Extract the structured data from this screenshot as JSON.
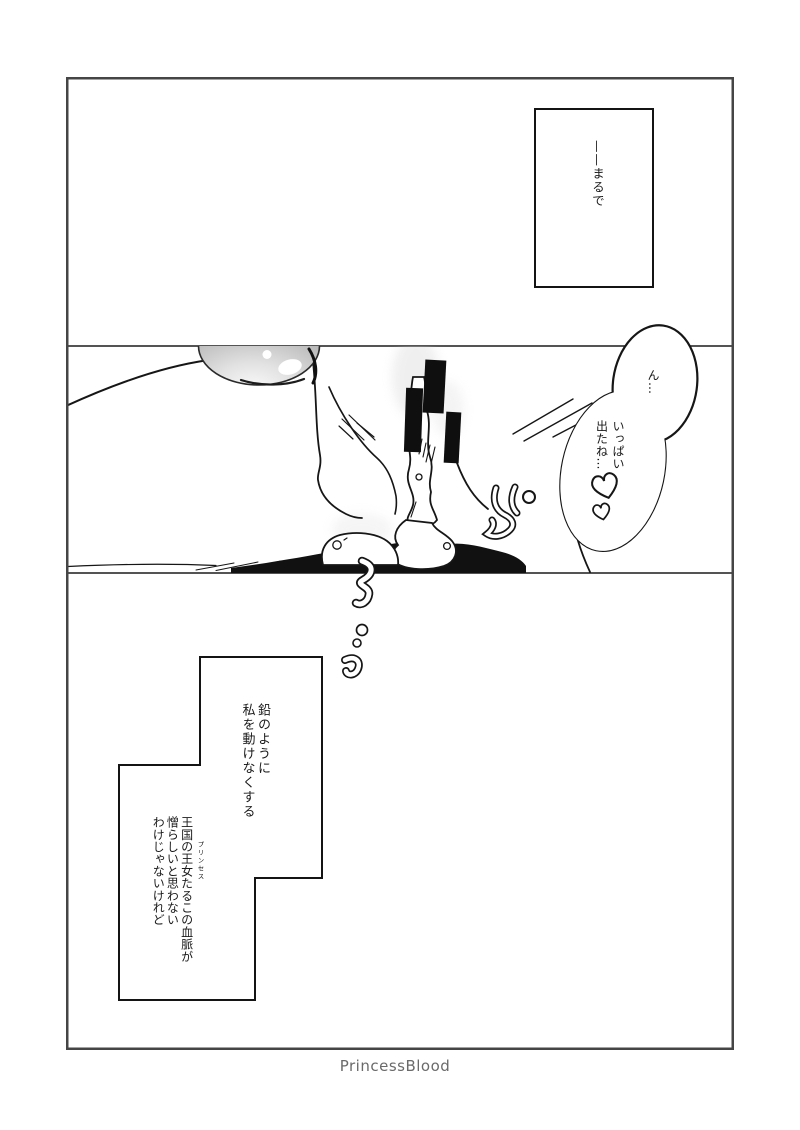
{
  "page": {
    "footer_credit": "PrincessBlood"
  },
  "panel_top": {
    "caption": "——まるで"
  },
  "panel_middle": {
    "bubble": {
      "moan": "ん…",
      "col1": "いっぱい",
      "col2": "出たね…",
      "hearts": "♡♡"
    }
  },
  "panel_bottom": {
    "monologue1": {
      "col1": "鉛のように",
      "col2": "私を動けなくする"
    },
    "monologue2": {
      "col1": "王国の王女たるこの血脈が",
      "ruby": "プリンセス",
      "col2": "憎らしいと思わない",
      "col3": "わけじゃないけれど"
    }
  },
  "colors": {
    "paper": "#ffffff",
    "ink": "#161616",
    "frame_border": "#454545",
    "censor_bar": "#0f0f0f",
    "footer_text": "#6a6a6a"
  }
}
